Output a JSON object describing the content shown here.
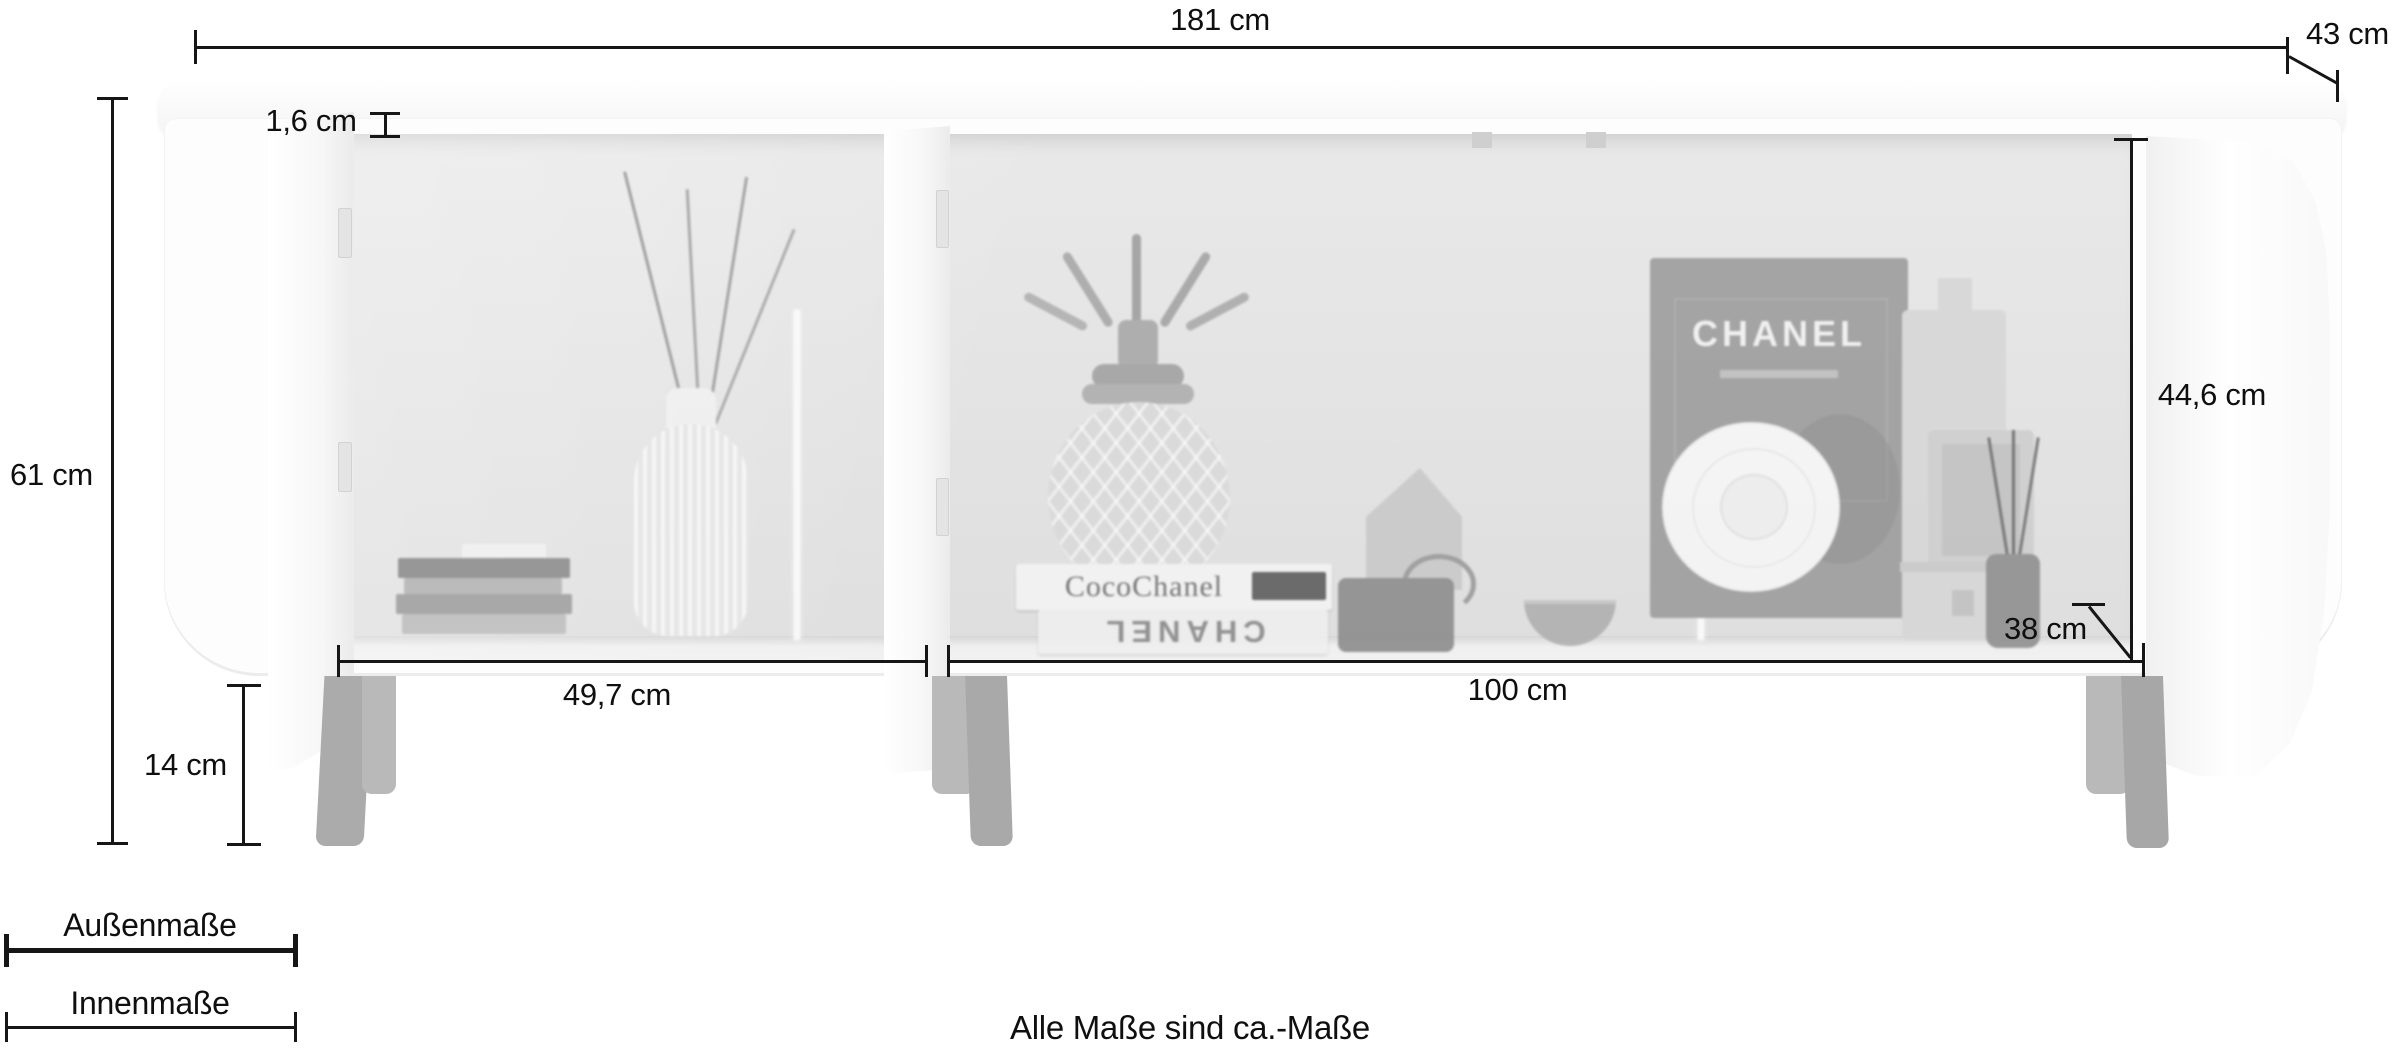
{
  "dims": {
    "width_total": "181 cm",
    "depth_total": "43 cm",
    "height_total": "61 cm",
    "top_thickness": "1,6 cm",
    "inner_height": "44,6 cm",
    "inner_depth": "38 cm",
    "inner_width_left": "49,7 cm",
    "inner_width_right": "100 cm",
    "leg_height": "14 cm"
  },
  "legend": {
    "outer": "Außenmaße",
    "inner": "Innenmaße"
  },
  "note": "Alle Maße sind ca.-Maße",
  "decor": {
    "cover_title": "CHANEL",
    "book_top": "CocoChanel",
    "book_bottom": "CHANEL"
  },
  "colors": {
    "dimension_line": "#161616",
    "cabinet_body": "#fdfdfd",
    "interior": "#e3e3e3",
    "legs": "#a9a9a9"
  }
}
